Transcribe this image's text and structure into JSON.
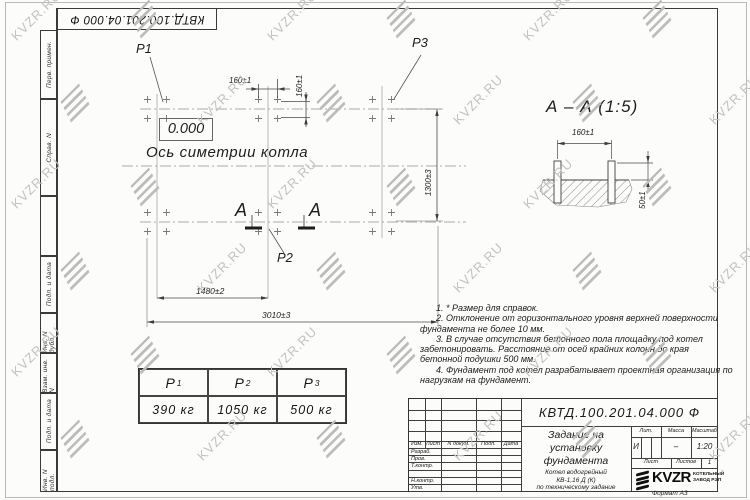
{
  "sheet": {
    "doc_number": "КВТД.100.201.04.000  Ф",
    "format_label": "Формат А3"
  },
  "watermark": {
    "text": "KVZR.RU"
  },
  "side_strip": {
    "cells": [
      {
        "label": "Перв. примен."
      },
      {
        "label": "Справ. N"
      },
      {
        "label": ""
      },
      {
        "label": "Подп. и дата"
      },
      {
        "label": "Инв. N дубл."
      },
      {
        "label": "Взам. инв. N"
      },
      {
        "label": "Подп. и дата"
      },
      {
        "label": "Инв. N подл."
      }
    ]
  },
  "plan": {
    "point_labels": {
      "p1": "Р1",
      "p2": "Р2",
      "p3": "Р3"
    },
    "elevation_mark": "0.000",
    "axis_label": "Ось симетрии котла",
    "section_letter_left": "А",
    "section_letter_right": "А",
    "dims": {
      "bolt_spacing_h": "160±1",
      "bolt_spacing_v": "160±1",
      "width": "1300±3",
      "left_span": "1480±2",
      "total_span": "3010±3"
    }
  },
  "section_view": {
    "title": "А – А (1:5)",
    "dims": {
      "bolt_spacing": "160±1",
      "protrusion": "50±1"
    }
  },
  "notes": {
    "items": [
      "1. * Размер для справок.",
      "2. Отклонение от горизонтального уровня верхней поверхности фундамента не более 10 мм.",
      "3. В случае отсутствия бетонного пола площадку под котел забетонировать. Расстояние от осей крайних колонн до края бетонной подушки 500 мм.",
      "4. Фундамент под котел разрабатывает проектная организация по нагрузкам на фундамент."
    ]
  },
  "load_table": {
    "columns": [
      {
        "base": "Р",
        "sub": "1"
      },
      {
        "base": "Р",
        "sub": "2"
      },
      {
        "base": "Р",
        "sub": "3"
      }
    ],
    "values": [
      "390 кг",
      "1050 кг",
      "500 кг"
    ]
  },
  "title_block": {
    "doc_number": "КВТД.100.201.04.000  Ф",
    "title_lines": [
      "Задание на",
      "установку",
      "фундамента"
    ],
    "product_lines": [
      "Котел водогрейный",
      "КВ-1,16 Д (К)",
      "по техническому задание"
    ],
    "rev_header": [
      "Изм.",
      "Лист",
      "N докум.",
      "Подп.",
      "Дата"
    ],
    "row_labels": [
      "Разраб.",
      "Пров.",
      "Т.контр.",
      "",
      "Н.контр.",
      "Утв."
    ],
    "lit_header": "Лит.",
    "mass_header": "Масса",
    "scale_header": "Масштаб",
    "lit_value": "И",
    "mass_value": "–",
    "scale_value": "1:20",
    "sheet_label": "Лист",
    "sheets_label": "Листов",
    "sheets_value": "1",
    "logo_text": "KVZR",
    "logo_caption_lines": [
      "КОТЕЛЬНЫЙ",
      "ЗАВОД РЭП"
    ],
    "format_label": "Формат А3"
  }
}
